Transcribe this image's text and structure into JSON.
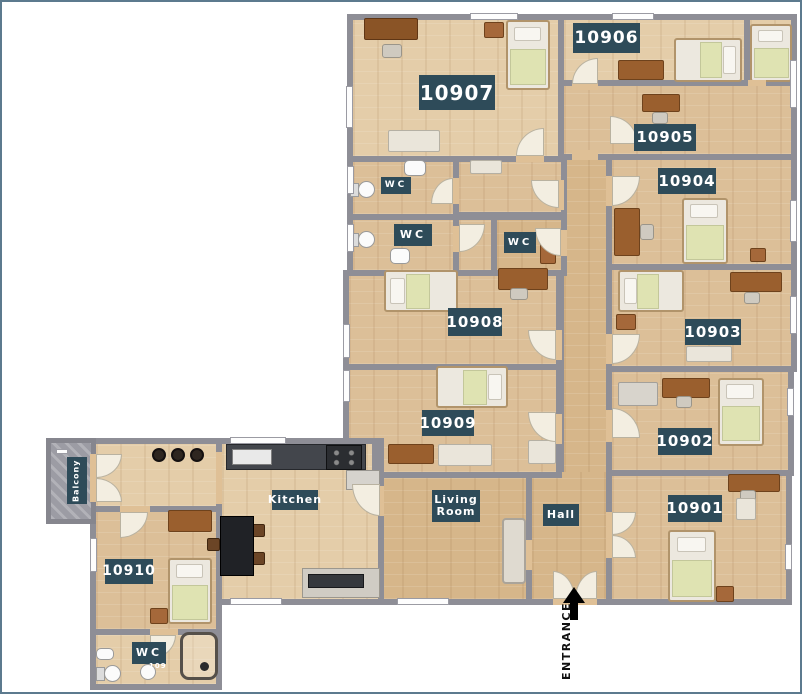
{
  "labels": {
    "r10901": "10901",
    "r10902": "10902",
    "r10903": "10903",
    "r10904": "10904",
    "r10905": "10905",
    "r10906": "10906",
    "r10907": "10907",
    "r10908": "10908",
    "r10909": "10909",
    "r10910": "10910",
    "wc": "WC",
    "wc_num": "109",
    "kitchen": "Kitchen",
    "living": "Living Room",
    "hall": "Hall",
    "balcony": "Balcony",
    "entrance": "ENTRANCE"
  },
  "colors": {
    "label_bg": "#2e4b59",
    "label_text": "#ffffff",
    "wall": "#8e8e96",
    "floor": "#dcbf98",
    "balcony": "#9c9ca4",
    "blanket": "#dfe3b2",
    "arrow": "#000000"
  }
}
